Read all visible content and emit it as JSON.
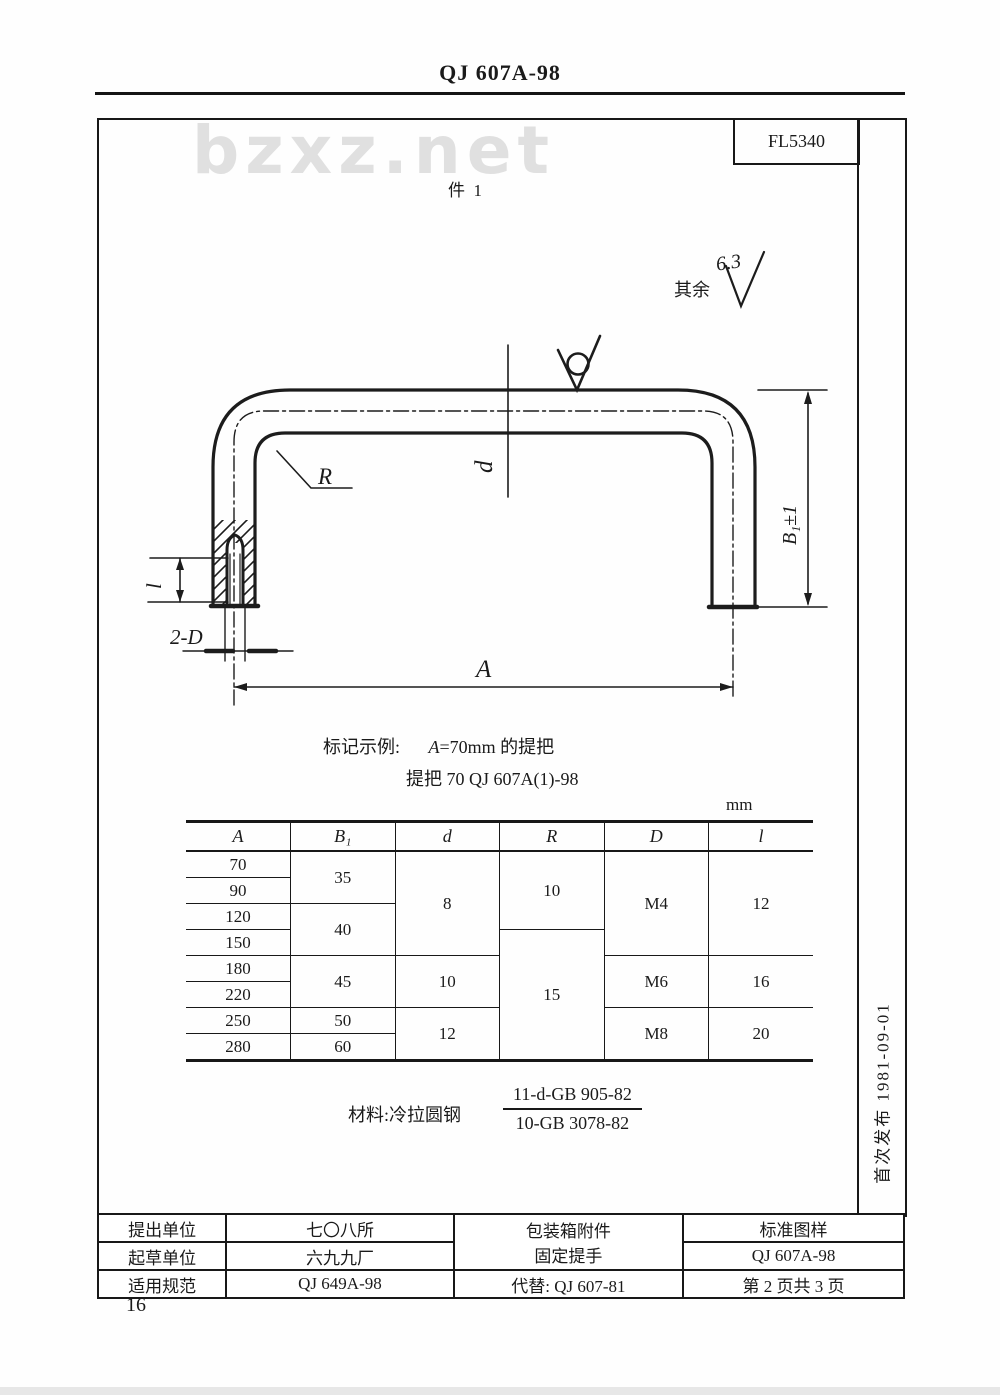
{
  "page": {
    "title": "QJ 607A-98",
    "page_number": "16",
    "watermark": "bzxz.net"
  },
  "drawing": {
    "code": "FL5340",
    "part_label": "件  1",
    "rest_label": "其余",
    "rest_roughness": "6.3",
    "dim_R": "R",
    "dim_d": "d",
    "dim_B": "B₁±1",
    "dim_A": "A",
    "dim_l": "l",
    "dim_2D": "2-D"
  },
  "marking": {
    "label": "标记示例:",
    "var": "A",
    "rest": "=70mm 的提把",
    "line2": "提把 70    QJ 607A(1)-98"
  },
  "table": {
    "unit": "mm",
    "headers": [
      "A",
      "B₁",
      "d",
      "R",
      "D",
      "l"
    ],
    "a_values": [
      "70",
      "90",
      "120",
      "150",
      "180",
      "220",
      "250",
      "280"
    ],
    "b1": [
      "35",
      "40",
      "45",
      "50",
      "60"
    ],
    "d": [
      "8",
      "10",
      "12"
    ],
    "r": [
      "10",
      "15"
    ],
    "D": [
      "M4",
      "M6",
      "M8"
    ],
    "l": [
      "12",
      "16",
      "20"
    ]
  },
  "material": {
    "label": "材料:冷拉圆钢",
    "numerator": "11-d-GB 905-82",
    "denominator": "10-GB 3078-82"
  },
  "release": {
    "text": "首次发布  1981-09-01"
  },
  "footer": {
    "rows": [
      {
        "label": "提出单位",
        "value": "七〇八所"
      },
      {
        "label": "起草单位",
        "value": "六九九厂"
      },
      {
        "label": "适用规范",
        "value": "QJ 649A-98"
      }
    ],
    "product_line1": "包装箱附件",
    "product_line2": "固定提手",
    "replace": "代替: QJ 607-81",
    "std_line1": "标准图样",
    "std_line2": "QJ 607A-98",
    "std_line3": "第 2 页共 3 页"
  }
}
